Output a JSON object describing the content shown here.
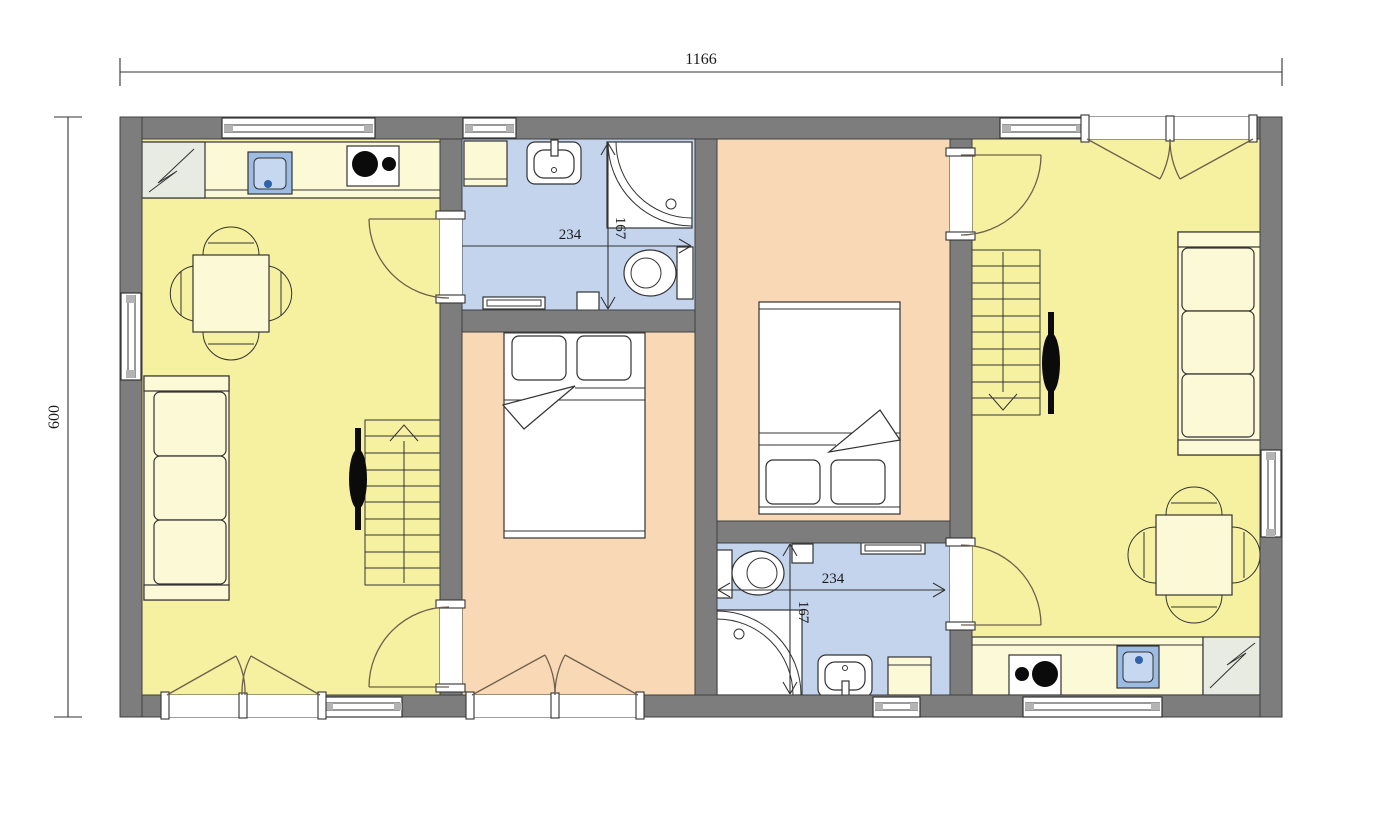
{
  "drawing": {
    "type": "architectural-floor-plan",
    "dimension_labels": {
      "overall_width": "1166",
      "overall_height": "600",
      "bathroom_top": {
        "width": "234",
        "height": "167"
      },
      "bathroom_bottom": {
        "width": "234",
        "height": "167"
      }
    },
    "colors": {
      "wall": "#7d7d7d",
      "outline": "#3f3f3f",
      "line": "#333333",
      "door_arc": "#6e5f4d",
      "living_floor": "#f6f1a0",
      "bedroom_floor": "#f8d8b5",
      "bathroom_floor": "#c4d4ed",
      "furniture_fill": "#fcf9d6",
      "fridge_fill": "#e8ebe1",
      "kitchen_sink": "#9cbce4",
      "kitchen_sink_inner": "#c6d8f0",
      "sink_dot": "#2f62a7",
      "window_cap": "#b3b3b3",
      "black": "#0b0b0b",
      "dim_line": "#333333",
      "dim_text": "#1a1a1a"
    },
    "rooms": [
      {
        "id": "living-room-left",
        "floor": "yellow",
        "contents": [
          "kitchen-counter",
          "fridge",
          "kitchen-sink",
          "stove",
          "dining-table",
          "chairs",
          "sofa",
          "stairs",
          "tv"
        ]
      },
      {
        "id": "bathroom-top",
        "floor": "blue",
        "contents": [
          "cabinet",
          "washbasin",
          "corner-shower",
          "toilet",
          "radiator"
        ]
      },
      {
        "id": "bedroom-middle",
        "floor": "peach",
        "contents": [
          "double-bed"
        ]
      },
      {
        "id": "bedroom-right",
        "floor": "peach",
        "contents": [
          "double-bed"
        ]
      },
      {
        "id": "bathroom-bottom",
        "floor": "blue",
        "contents": [
          "toilet",
          "corner-shower",
          "washbasin",
          "cabinet",
          "radiator"
        ]
      },
      {
        "id": "living-room-right",
        "floor": "yellow",
        "contents": [
          "stairs",
          "tv",
          "sofa",
          "dining-table",
          "chairs",
          "kitchen-counter",
          "stove",
          "kitchen-sink",
          "fridge"
        ]
      }
    ]
  }
}
